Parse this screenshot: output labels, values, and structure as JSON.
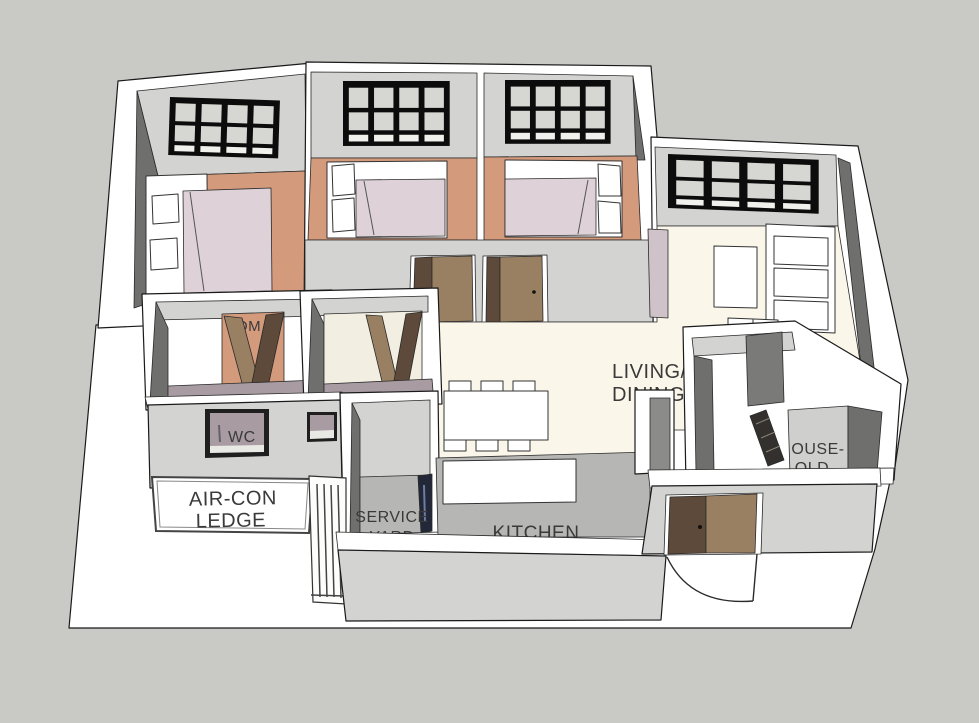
{
  "app": {
    "name": "3D apartment floor plan render"
  },
  "palette": {
    "background": "#c9c9c5",
    "ground": "#ffffff",
    "wall_top": "#ffffff",
    "wall_light": "#d3d3d1",
    "wall_mid": "#bdbdbb",
    "wall_dark": "#6f6f6d",
    "floor_bedroom": "#d49a7c",
    "floor_living": "#faf7ea",
    "floor_bath": "#a89ca2",
    "floor_bath2": "#f2efe2",
    "floor_service": "#b6b6b4",
    "floor_shelter": "#cfcfcd",
    "mattress": "#ded2d8",
    "pillow": "#ffffff",
    "door_brown": "#9a8063",
    "door_brown_dark": "#5e4a3a",
    "door_dark": "#33302d",
    "window_frame": "#0c0c0c",
    "window_glass": "#d6d6d2",
    "appliance_navy": "#232838",
    "console_mauve": "#cfc2c8",
    "counter": "#ffffff",
    "text": "#3a3a3a"
  },
  "labels": {
    "living_dining": {
      "line1": "LIVING/",
      "line2": "DINING"
    },
    "kitchen": "KITCHEN",
    "service_yard": {
      "line1": "SERVICE",
      "line2": "YARD"
    },
    "aircon_ledge": {
      "line1": "AIR-CON",
      "line2": "LEDGE"
    },
    "wc": "WC",
    "household_shelter": {
      "line1": "OUSE-",
      "line2": "OLD"
    },
    "bedroom_label_fragment": "OM"
  }
}
